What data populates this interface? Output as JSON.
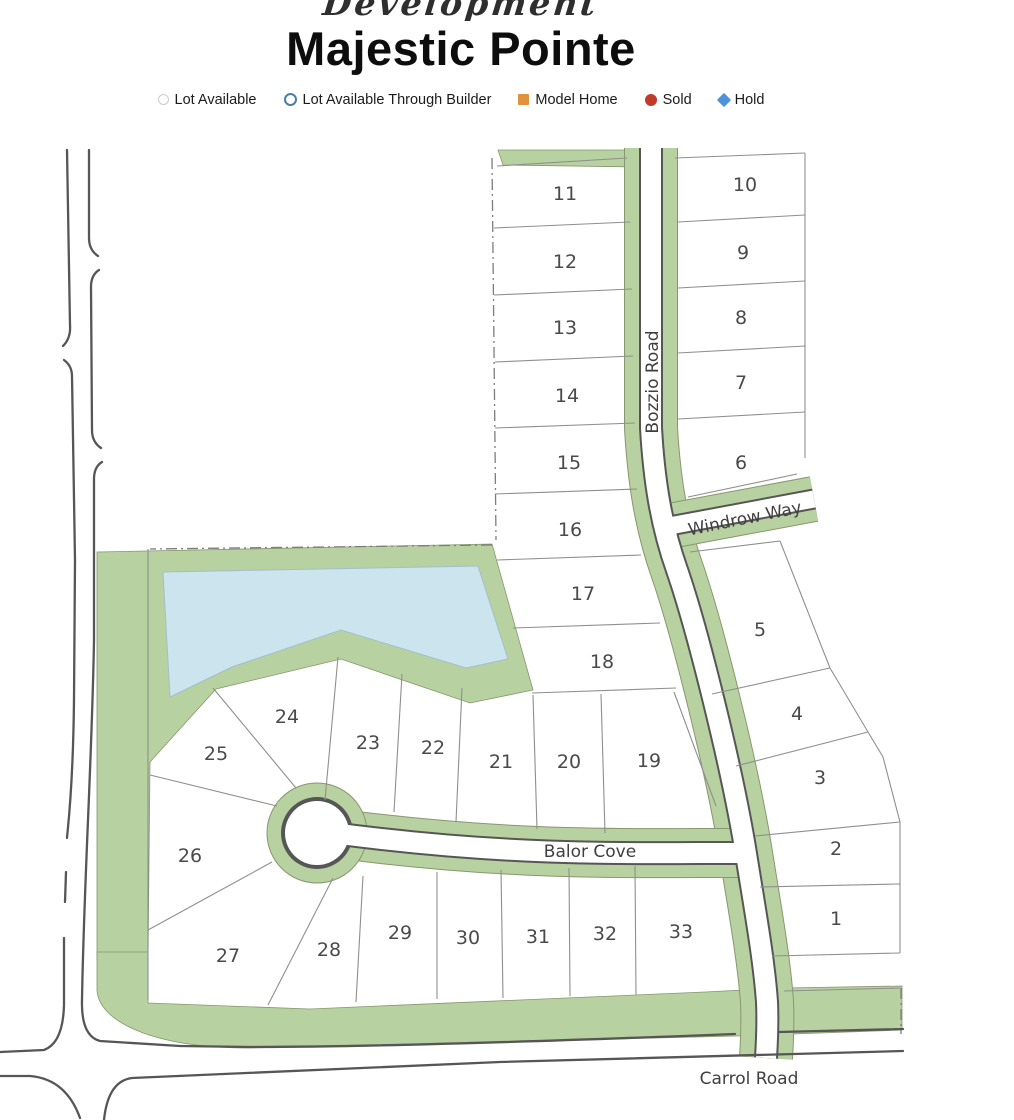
{
  "header": {
    "script_text": "Development",
    "title": "Majestic Pointe"
  },
  "legend": {
    "items": [
      {
        "label": "Lot Available",
        "marker": "gray-outline-circle",
        "color": "#cccccc"
      },
      {
        "label": "Lot Available Through Builder",
        "marker": "blue-outline-circle",
        "color": "#4a7fa5"
      },
      {
        "label": "Model Home",
        "marker": "orange-square",
        "color": "#e2913c"
      },
      {
        "label": "Sold",
        "marker": "red-circle",
        "color": "#c13b2a"
      },
      {
        "label": "Hold",
        "marker": "blue-diamond",
        "color": "#4e93d9"
      }
    ]
  },
  "map": {
    "road_labels": {
      "bozzio": "Bozzio Road",
      "windrow": "Windrow Way",
      "balor": "Balor Cove",
      "carrol": "Carrol Road"
    },
    "lot_numbers": [
      "1",
      "2",
      "3",
      "4",
      "5",
      "6",
      "7",
      "8",
      "9",
      "10",
      "11",
      "12",
      "13",
      "14",
      "15",
      "16",
      "17",
      "18",
      "19",
      "20",
      "21",
      "22",
      "23",
      "24",
      "25",
      "26",
      "27",
      "28",
      "29",
      "30",
      "31",
      "32",
      "33"
    ],
    "features": {
      "pond": "pond",
      "greenbelt": "landscape-buffer"
    }
  },
  "colors": {
    "greenbelt": "#b7d1a0",
    "greenbelt_outline": "#87976f",
    "pond": "#cbe4ed",
    "pond_outline": "#a3bfc9",
    "road_edge": "#565656",
    "lot_line": "#8f8f8f",
    "label_text": "#4a4a4a"
  }
}
